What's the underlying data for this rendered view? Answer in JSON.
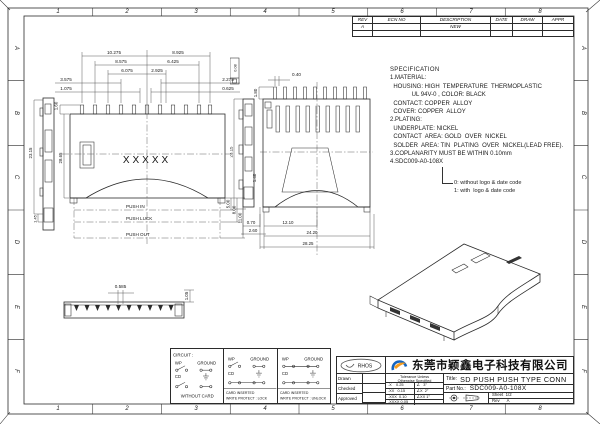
{
  "grid": {
    "cols": [
      "1",
      "2",
      "3",
      "4",
      "5",
      "6",
      "7",
      "8"
    ],
    "rows": [
      "A",
      "B",
      "C",
      "D",
      "E",
      "F"
    ]
  },
  "rev_table": {
    "h_rev": "REV",
    "h_ecn": "ECN NO",
    "h_desc": "DESCRIPTION",
    "h_date": "DATE",
    "h_draw": "DRAW",
    "h_appr": "APPR",
    "r1_rev": "A",
    "r1_desc": "NEW"
  },
  "spec": {
    "title": "SPECIFICATION",
    "lines": [
      "1.MATERIAL:",
      "  HOUSING: HIGH  TEMPERATURE  THERMOPLASTIC",
      "             UL 94V-0 , COLOR: BLACK",
      "  CONTACT: COPPER  ALLOY",
      "  COVER: COPPER  ALLOY",
      "2.PLATING:",
      "  UNDERPLATE: NICKEL",
      "  CONTACT  AREA: GOLD  OVER  NICKEL",
      "  SOLDER  AREA: TIN  PLATING  OVER  NICKEL(LEAD FREE).",
      "3.COPLANARITY MUST BE WITHIN 0.10mm",
      "4.SDC009-A0-108X"
    ],
    "note0": "0: without logo & date code",
    "note1": "1: with  logo & date code"
  },
  "front": {
    "tl": [
      "10.275",
      "8.575",
      "6.075",
      "3.575",
      "1.075"
    ],
    "tr": [
      "8.925",
      "6.425",
      "2.925",
      "2.275",
      "0.625"
    ],
    "h_top": "1.60",
    "h_body": "28.65",
    "xmark": "XXXXX",
    "push_in": "PUSH  IN",
    "push_luck": "PUSH  LUCK",
    "push_out": "PUSH  OUT",
    "d5": "5.00",
    "d8": "8.00",
    "d11": "11.00"
  },
  "side": {
    "h": "23.15",
    "b": "1.45"
  },
  "rear": {
    "pin_w": "0.40",
    "pin_h": "1.80",
    "h": "23.15",
    "d140": "1.40",
    "d070": "0.70",
    "d260": "2.60",
    "b1": "12.10",
    "b2": "24.20",
    "b3": "28.25",
    "gdt": "0.08"
  },
  "bottom": {
    "pitch": "0.585",
    "h": "1.05"
  },
  "circuit": {
    "title": "CIRCUIT :",
    "wp": "WP",
    "ground": "GROUND",
    "cd": "CD",
    "c1": "WITHOUT  CARD",
    "c2a": "CARD  INSERTED",
    "c2b": "WRITE  PROTECT : LOCK",
    "c3a": "CARD  INSERTED",
    "c3b": "WRITE  PROTECT : UNLOCK"
  },
  "tb": {
    "rohs": "RHOS",
    "company": "东莞市颖鑫电子科技有限公司",
    "drawn": "Drawn",
    "checked": "Checked",
    "approved": "Approved",
    "tol1": "Tolerance Unless",
    "tol2": "Otherwise Specified",
    "t1": ".X    0.25",
    "a1": "∠   3°",
    "t2": ".XX   0.15",
    "a2": "∠X  2°",
    "t3": ".XXX  0.10",
    "a3": "∠XX 1°",
    "t4": ".XXXX 0.05",
    "a4": "",
    "title_label": "Title:",
    "title_value": "SD  PUSH  PUSH  TYPE  CONN",
    "part_label": "Part No.:",
    "part_value": "SDC009-A0-108X",
    "sheet": "Sheet  1/2",
    "rev": "Rev      A"
  }
}
